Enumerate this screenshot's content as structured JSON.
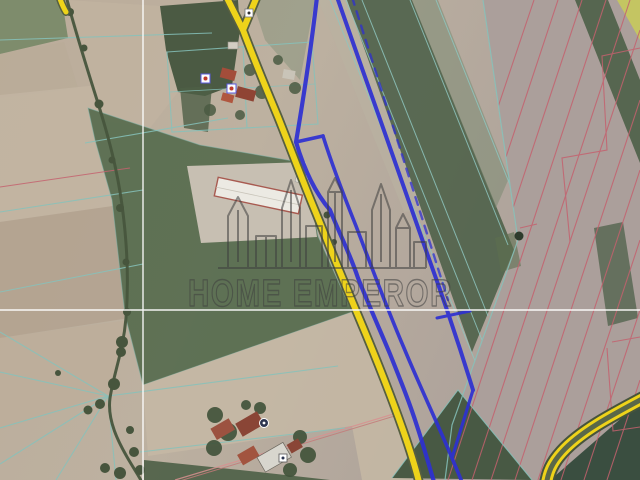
{
  "map": {
    "type": "satellite-cadastral-map",
    "watermark": {
      "brand": "HOME EMPEROR",
      "logo": "city-skyline-outline-icon"
    },
    "colors": {
      "road_yellow": "#eed31a",
      "road_casing_olive": "#565f41",
      "highlighted_parcel_blue": "#2e30d2",
      "cadastral_line_red": "#c4616e",
      "parcel_line_teal": "#86c2bb",
      "crosshair_white": "#ffffff",
      "watermark_gray": "#3f3f3f"
    },
    "markers": [
      {
        "name": "building-marker-square-top"
      },
      {
        "name": "building-marker-red-dot-1"
      },
      {
        "name": "building-marker-red-dot-2"
      },
      {
        "name": "poi-marker-circle-bottom"
      },
      {
        "name": "building-marker-square-bottom"
      }
    ]
  }
}
